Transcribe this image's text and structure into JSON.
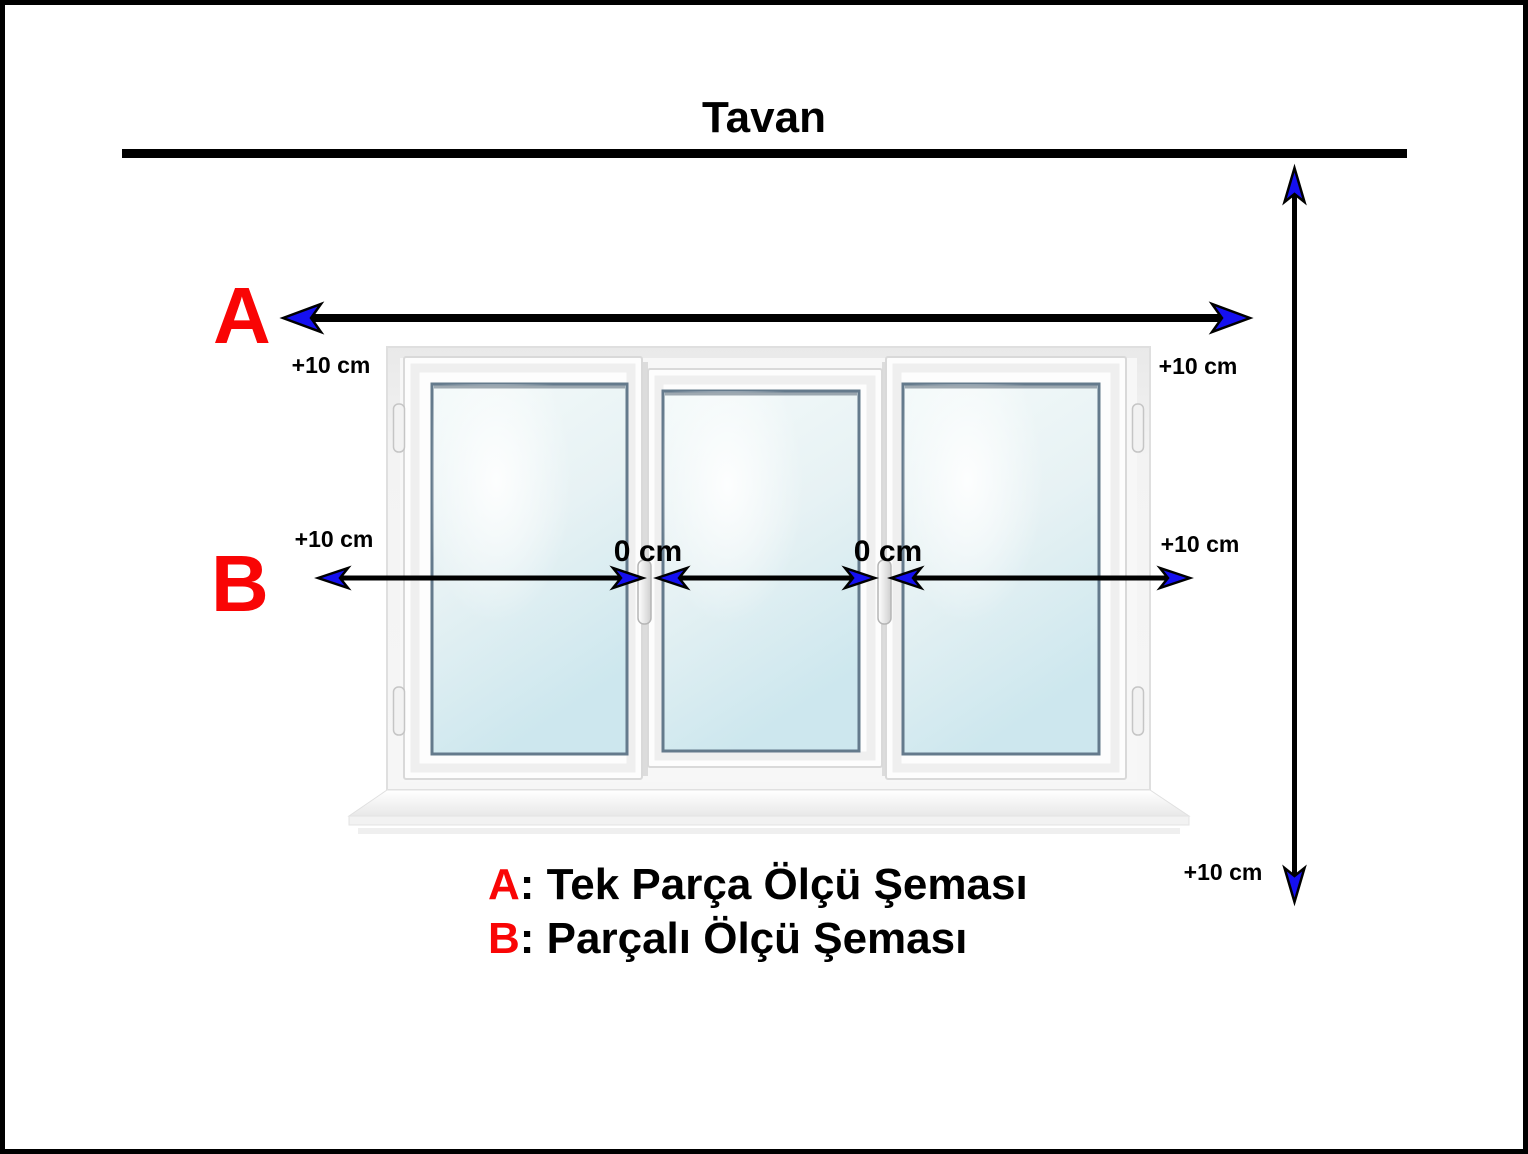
{
  "title": {
    "text": "Tavan"
  },
  "colors": {
    "accent_red": "#f90505",
    "arrowhead_blue": "#1510f0",
    "line_black": "#000000"
  },
  "scheme_a": {
    "letter": "A",
    "offset_left": "+10 cm",
    "offset_right": "+10 cm"
  },
  "scheme_b": {
    "letter": "B",
    "offset_left": "+10 cm",
    "offset_right": "+10 cm",
    "joint_labels": [
      "0 cm",
      "0 cm"
    ]
  },
  "vertical_measure": {
    "offset_bottom": "+10 cm"
  },
  "legend": {
    "items": [
      {
        "key": "A",
        "desc": ": Tek Parça Ölçü Şeması"
      },
      {
        "key": "B",
        "desc": ": Parçalı Ölçü Şeması"
      }
    ]
  }
}
